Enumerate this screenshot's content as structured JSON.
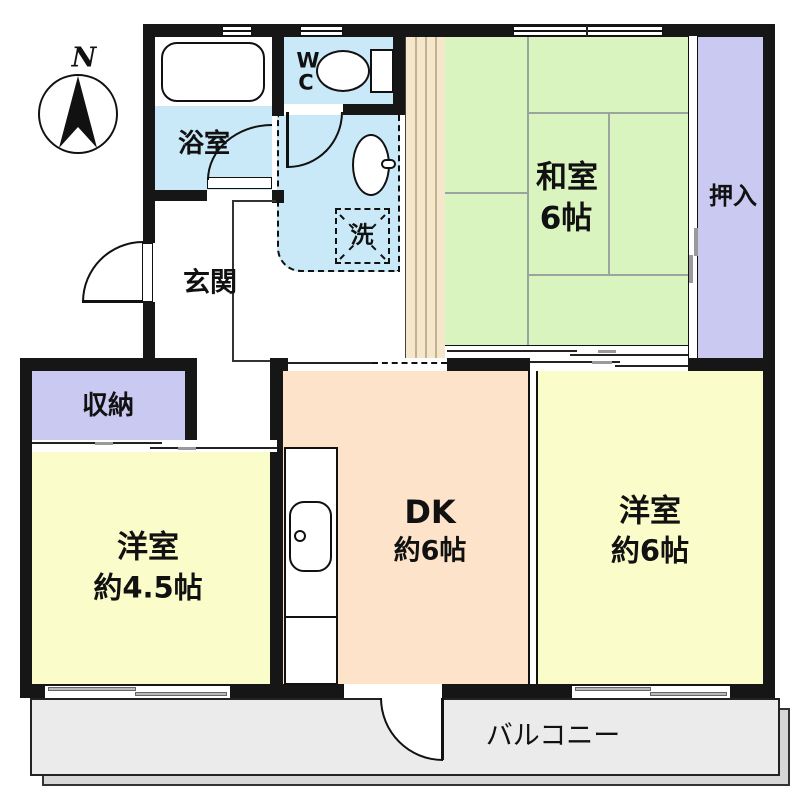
{
  "compass": {
    "north_label": "N"
  },
  "rooms": {
    "washitsu": {
      "name": "和室",
      "size": "6帖"
    },
    "oshiire": {
      "name": "押入"
    },
    "bath": {
      "name": "浴室"
    },
    "wc": {
      "line1": "W",
      "line2": "C"
    },
    "laundry": {
      "name": "洗"
    },
    "genkan": {
      "name": "玄関"
    },
    "storage": {
      "name": "収納"
    },
    "dk": {
      "name": "DK",
      "size": "約6帖"
    },
    "western_small": {
      "name": "洋室",
      "size": "約4.5帖"
    },
    "western_large": {
      "name": "洋室",
      "size": "約6帖"
    },
    "balcony": {
      "name": "バルコニー"
    }
  },
  "colors": {
    "tatami_green": "#d9f4be",
    "closet_purple": "#c9c9f1",
    "wet_area_cyan": "#c9e9f8",
    "western_room_yellow": "#fafcc9",
    "dk_peach": "#fce3c9",
    "wood_strip_tan": "#f5e7cb",
    "balcony_gray": "#ebebeb",
    "wall_black": "#161616"
  }
}
